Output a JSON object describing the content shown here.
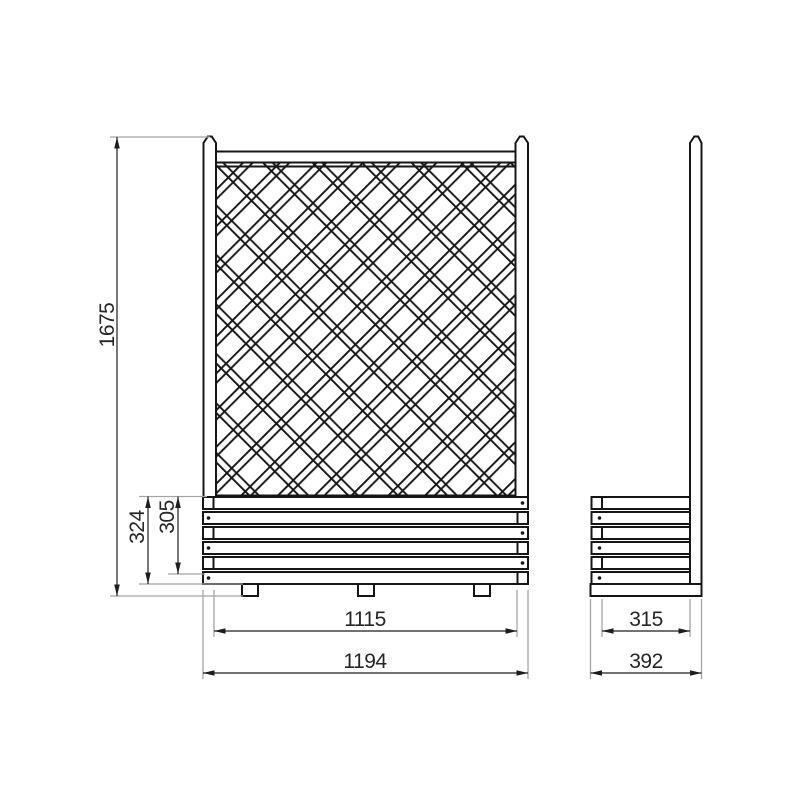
{
  "drawing": {
    "type": "technical-drawing",
    "subject": "lattice trellis panel with planter box, front and side elevation",
    "colors": {
      "background": "#ffffff",
      "line": "#161616",
      "extension_line": "#a5a5a5",
      "text": "#262626"
    },
    "dimensions": {
      "front": {
        "total_height": "1675",
        "planter_outer_height": "324",
        "planter_board_height": "305",
        "inner_width": "1115",
        "overall_width": "1194"
      },
      "side": {
        "inner_depth": "315",
        "overall_depth": "392"
      }
    }
  }
}
